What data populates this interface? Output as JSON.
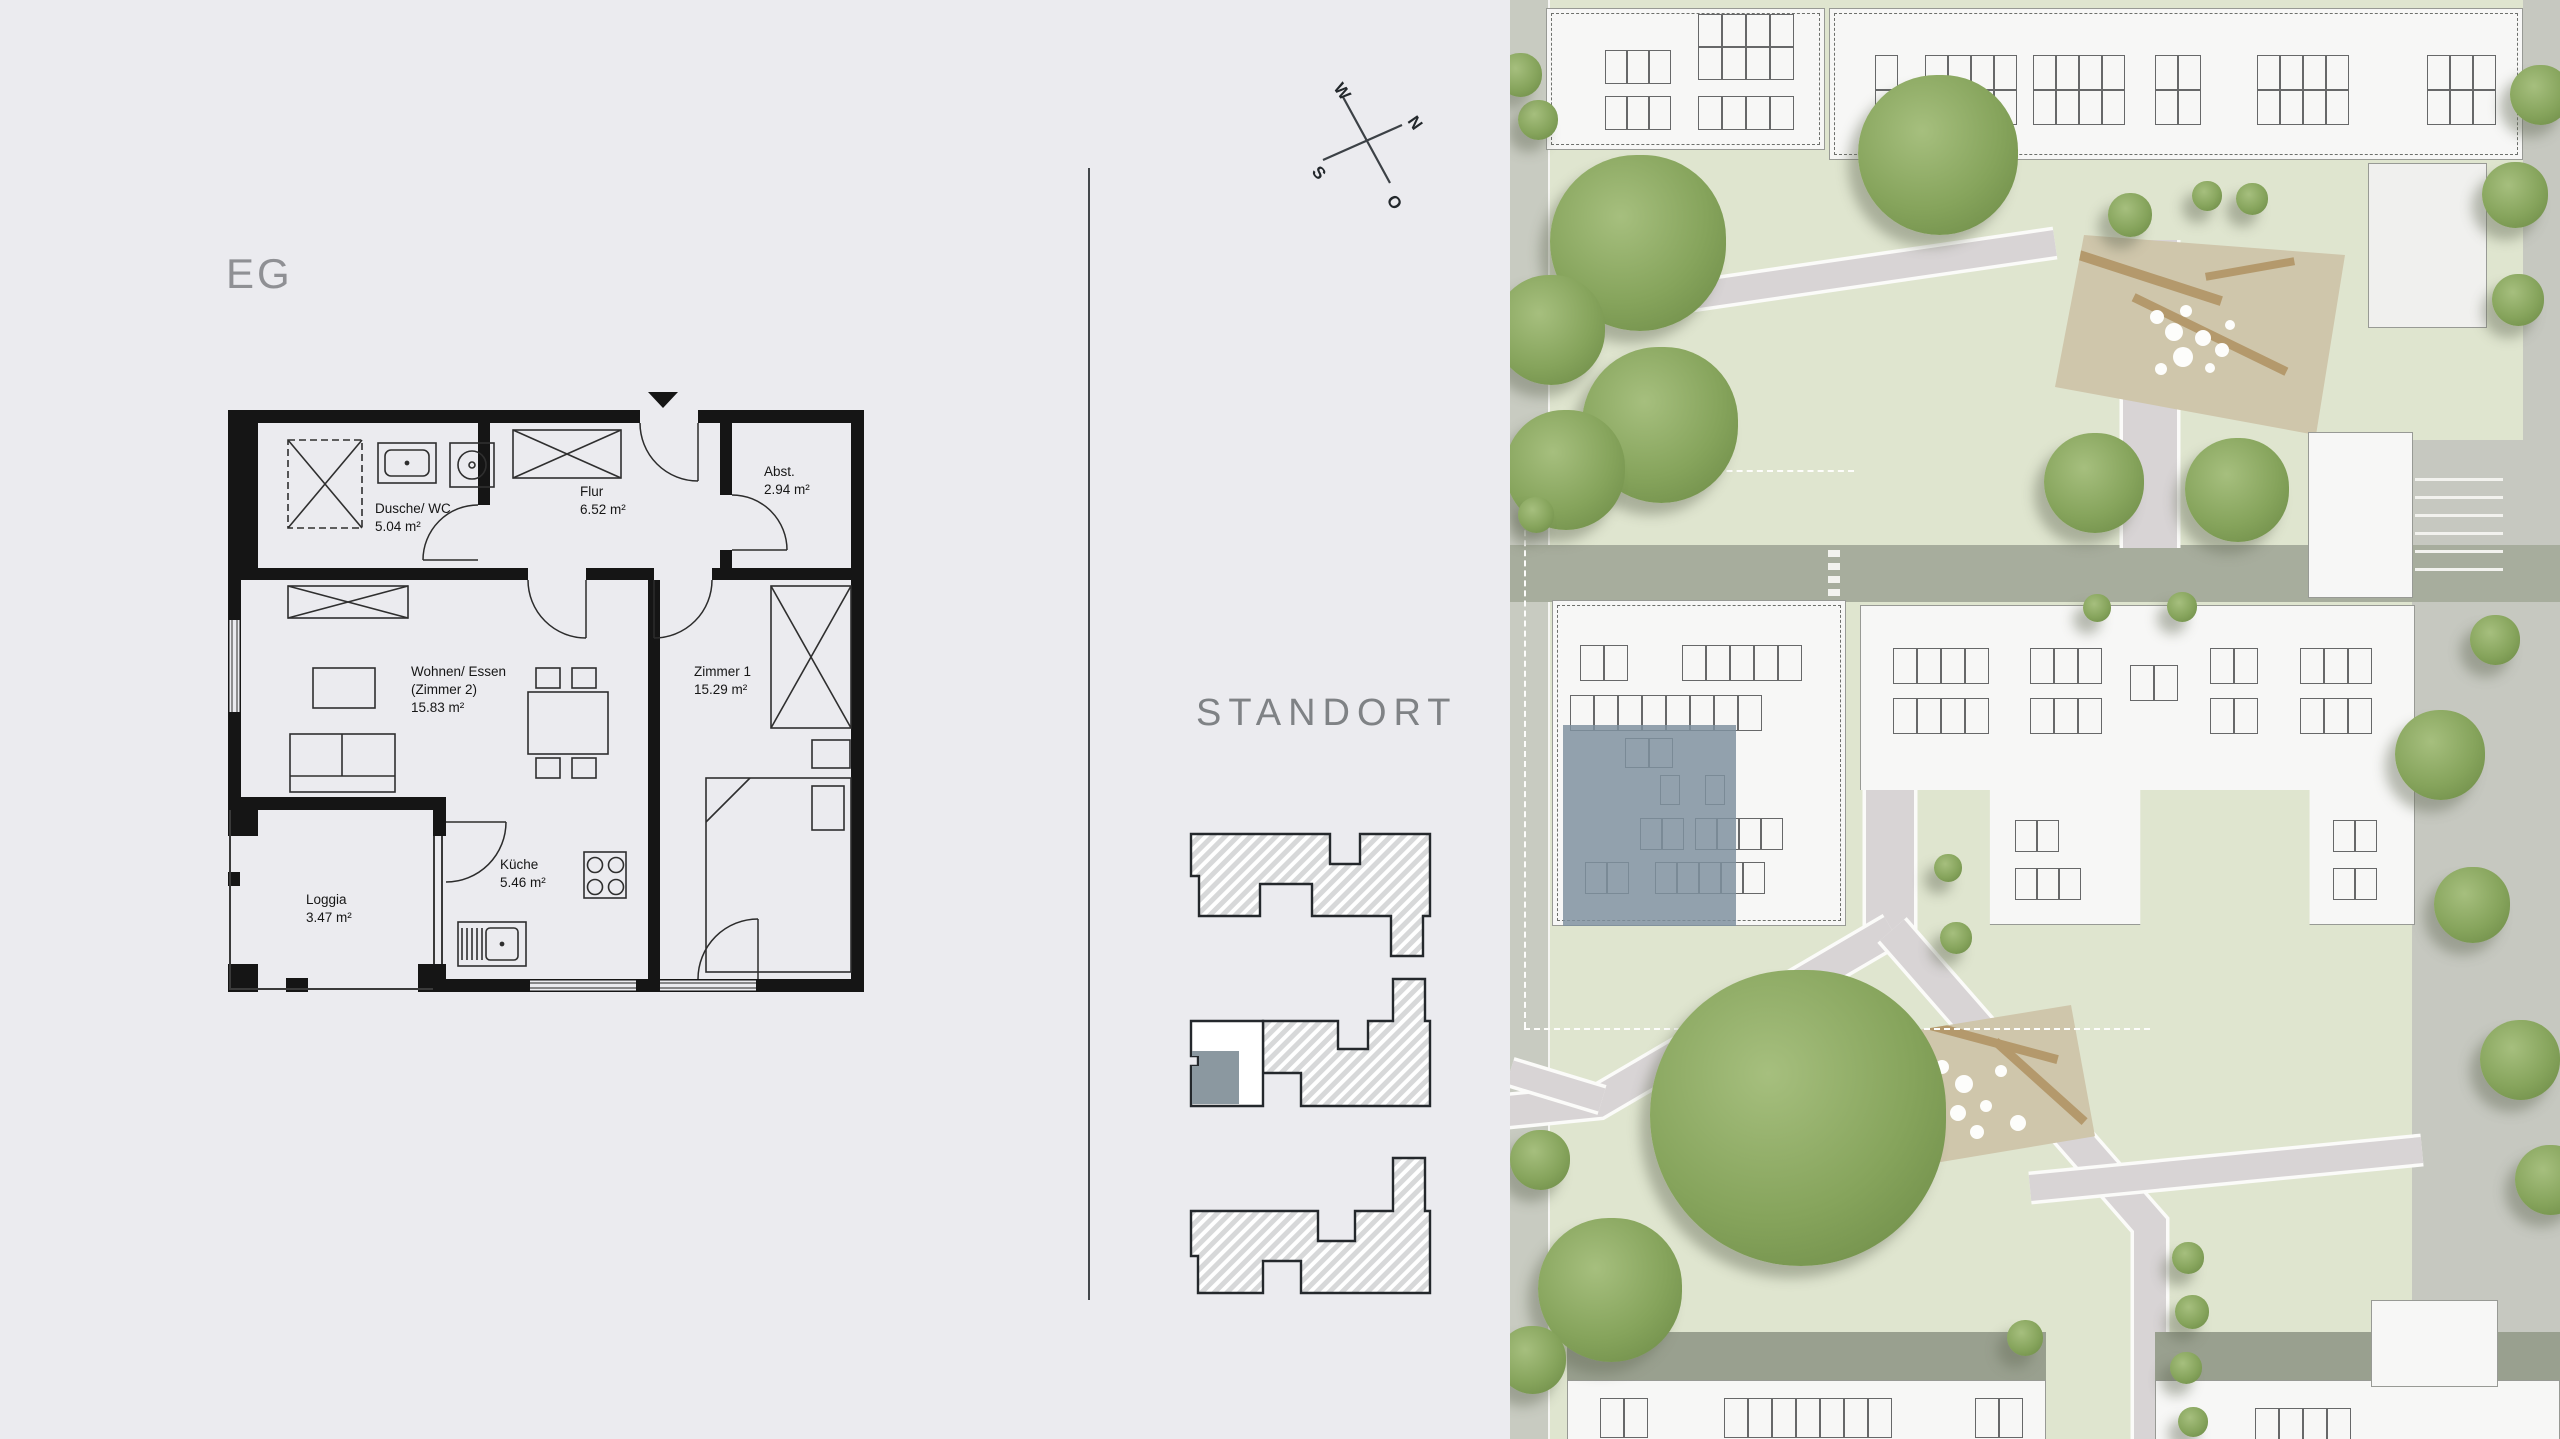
{
  "floor_plan": {
    "title": "EG",
    "rooms": [
      {
        "label": "Dusche/ WC",
        "area": "5.04 m²"
      },
      {
        "label": "Flur",
        "area": "6.52 m²"
      },
      {
        "label": "Abst.",
        "area": "2.94 m²"
      },
      {
        "label": "Wohnen/ Essen",
        "sublabel": "(Zimmer 2)",
        "area": "15.83 m²"
      },
      {
        "label": "Zimmer 1",
        "area": "15.29 m²"
      },
      {
        "label": "Küche",
        "area": "5.46 m²"
      },
      {
        "label": "Loggia",
        "area": "3.47 m²"
      }
    ]
  },
  "compass": {
    "north": "N",
    "east": "O",
    "south": "S",
    "west": "W"
  },
  "site": {
    "heading": "STANDORT"
  },
  "colors": {
    "page_background": "#ebebef",
    "plan_wall": "#151515",
    "unit_highlight": "#7e909e",
    "diagram_highlight": "#8b98a0",
    "lawn": "#dfe5cf",
    "road": "#a7ad9d",
    "path": "#d8d4d5",
    "roof_white": "#f7f7f6",
    "tree_green": "#86a45c",
    "playground_sand": "#cfc6ab",
    "diagram_hatch_gray": "#d7d8d9"
  }
}
